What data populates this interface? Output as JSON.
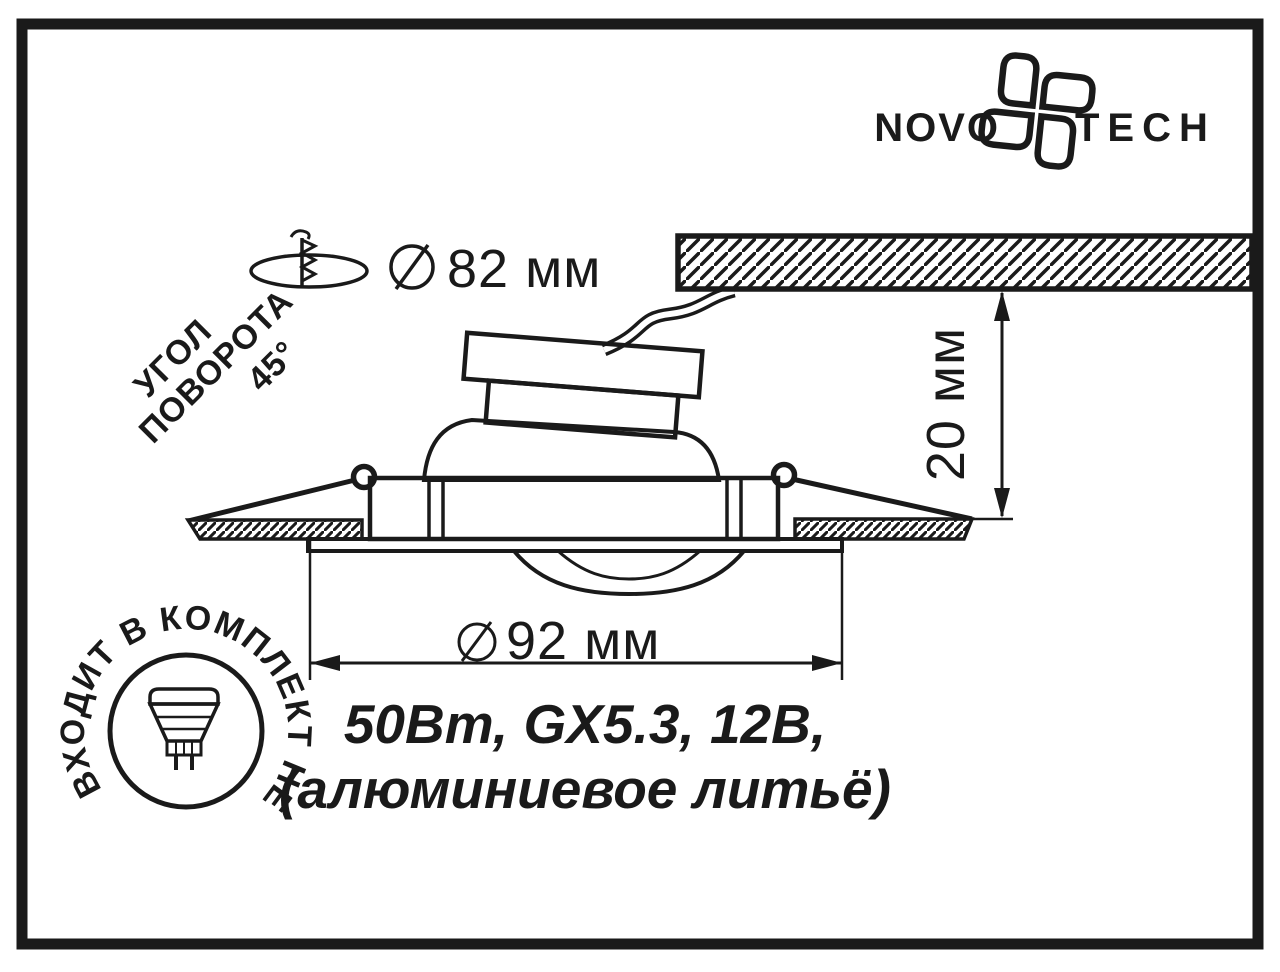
{
  "colors": {
    "ink": "#1a1a1a",
    "paper": "#ffffff"
  },
  "logo": {
    "word_left": "NOVO",
    "word_right": "TECH"
  },
  "annotations": {
    "cutout_dimension": {
      "value": "82 мм"
    },
    "rotation_angle": {
      "line1": "УГОЛ",
      "line2": "ПОВОРОТА",
      "line3": "45°"
    },
    "depth_dimension": {
      "value": "20 мм"
    },
    "diameter_dimension": {
      "value": "92 мм"
    },
    "spec_line1": "50Вт, GX5.3, 12В,",
    "spec_line2": "(алюминиевое литьё)",
    "stamp_text": "ВХОДИТ В КОМПЛЕКТ НЕ"
  }
}
